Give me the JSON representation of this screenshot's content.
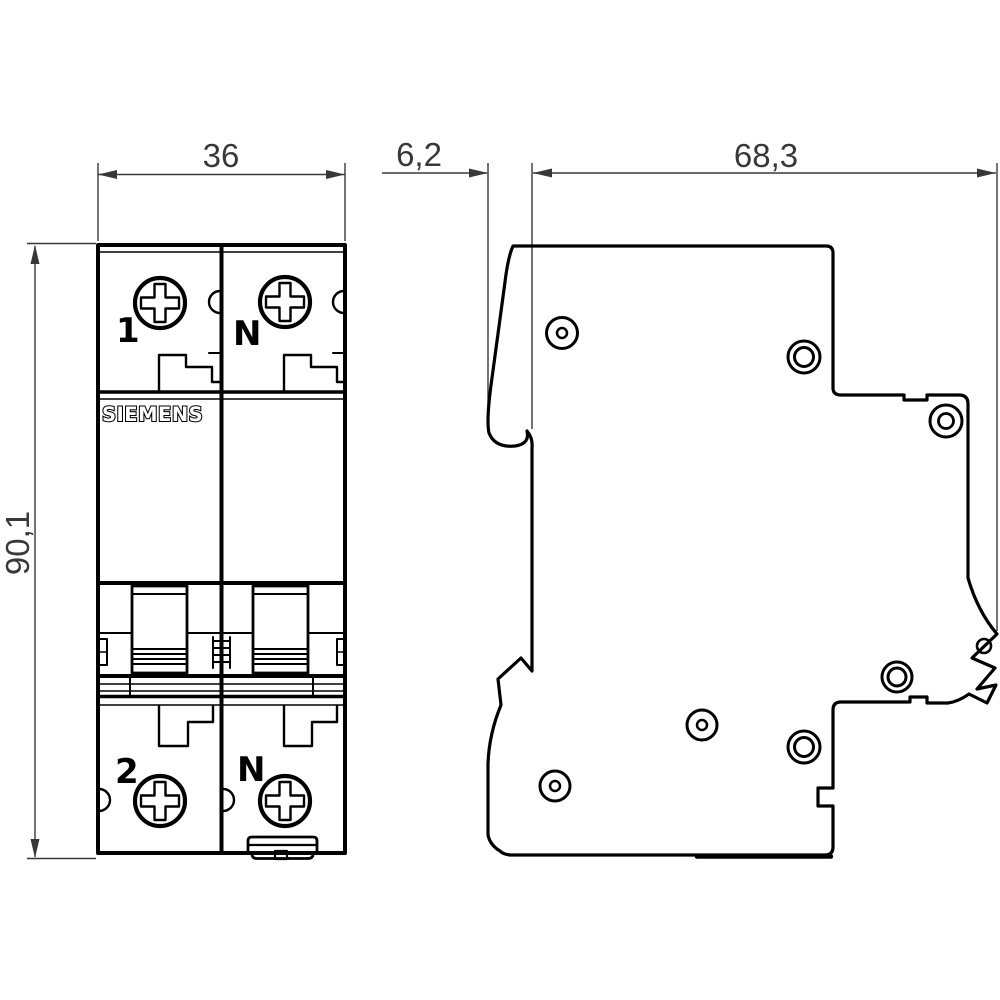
{
  "drawing": {
    "title": "Circuit breaker dimensional drawing",
    "brand": "SIEMENS",
    "front_view": {
      "pole_top_left_label": "1",
      "pole_top_right_label": "N",
      "pole_bottom_left_label": "2",
      "pole_bottom_right_label": "N"
    },
    "dimensions": {
      "width_mm": "36",
      "front_depth_mm": "6,2",
      "body_depth_mm": "68,3",
      "height_mm": "90,1"
    },
    "colors": {
      "outline": "#000000",
      "dimension": "#383838",
      "background": "#ffffff"
    }
  }
}
